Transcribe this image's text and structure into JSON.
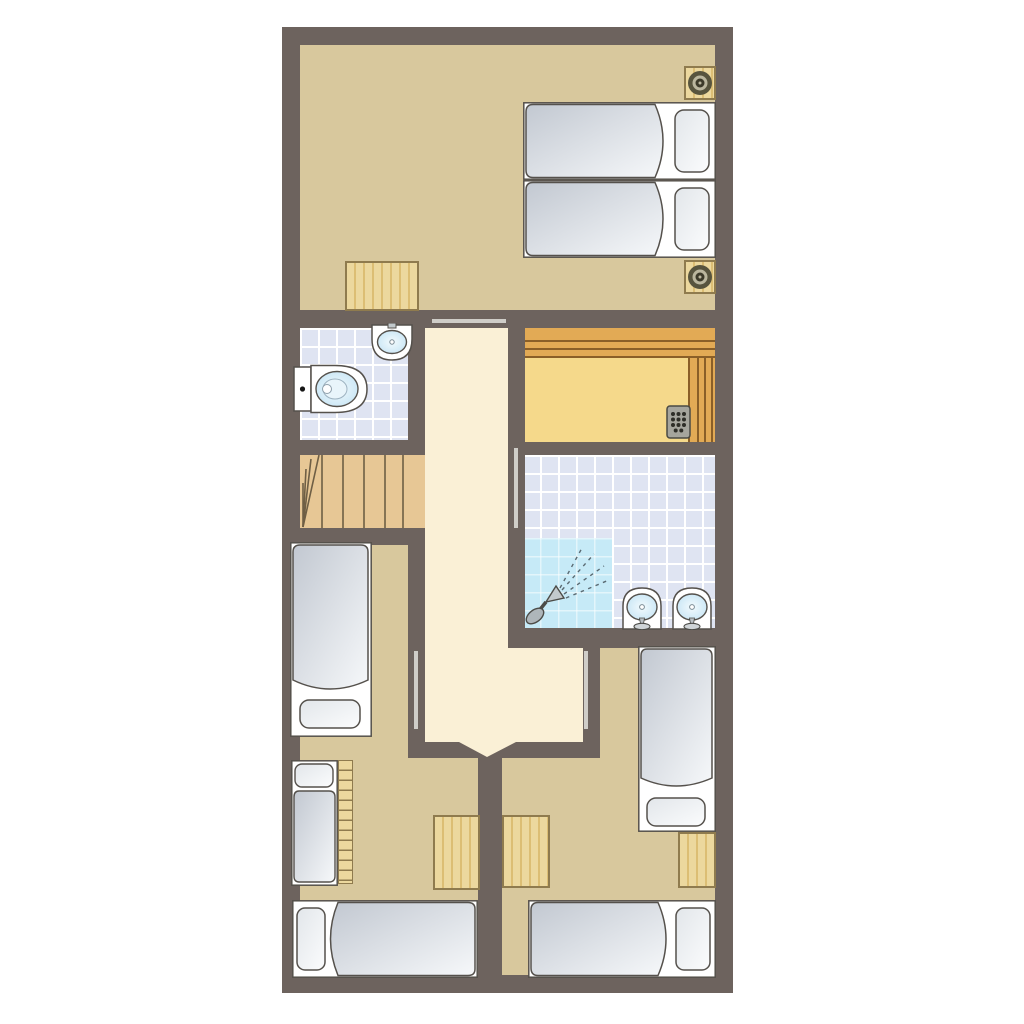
{
  "title": "apartment-floor-plan",
  "visible_text": [],
  "palette": {
    "bg": "#ffffff",
    "wall": "#6d635e",
    "floor": "#d8c89d",
    "hallway": "#faf0d6",
    "tile": "#dfe4f2",
    "grout": "#ffffff",
    "shower": "#c6eaf7",
    "sauna_floor": "#f5d98b",
    "bench": "#e2aa55",
    "bench_line": "#8a5f28",
    "wood": "#ecd89e",
    "wood_grain": "#dcbe74",
    "wood_border": "#8f7b4e",
    "stairs": "#e7c795",
    "stair_line": "#6f5f45",
    "outline": "#55514c",
    "white": "#ffffff",
    "duvet_dark": "#c2c8d1",
    "duvet_light": "#f6f8fa",
    "pillow_dark": "#e2e6ea",
    "pillow_light": "#fbfcfd",
    "basin_edge": "#c3e3f4",
    "basin_center": "#f2fafd",
    "metal": "#c2c9cc",
    "heater": "#a5a59d",
    "heater_dot": "#2e2e28",
    "door_line": "#cfcdc8",
    "speaker_outer": "#57543e",
    "speaker_mid": "#bab69e",
    "speaker_dot": "#3c3a2a"
  },
  "rooms": [
    "bedroom-top",
    "bathroom-wc",
    "hallway",
    "sauna",
    "shower-room",
    "bedroom-bottom-left",
    "bedroom-bottom-right",
    "staircase"
  ],
  "fixtures": {
    "beds_total": 7,
    "items": [
      "twin-bed-top-a",
      "twin-bed-top-b",
      "bed-left-middle",
      "bunk-bed-with-ladder",
      "bed-bottom-left",
      "bed-right-middle",
      "bed-bottom-right",
      "toilet",
      "washbasin-small",
      "washbasin-1",
      "washbasin-2",
      "shower-head",
      "sauna-heater",
      "sauna-bench-top",
      "sauna-bench-right",
      "staircase-winders",
      "desk-top-room",
      "table-left",
      "table-center-right",
      "table-right-wall",
      "nightstand-top",
      "nightstand-bottom",
      "ceiling-speaker-top",
      "ceiling-speaker-bottom",
      "door-opening-top",
      "door-opening-shower",
      "door-opening-left-room",
      "door-opening-right-room"
    ]
  }
}
